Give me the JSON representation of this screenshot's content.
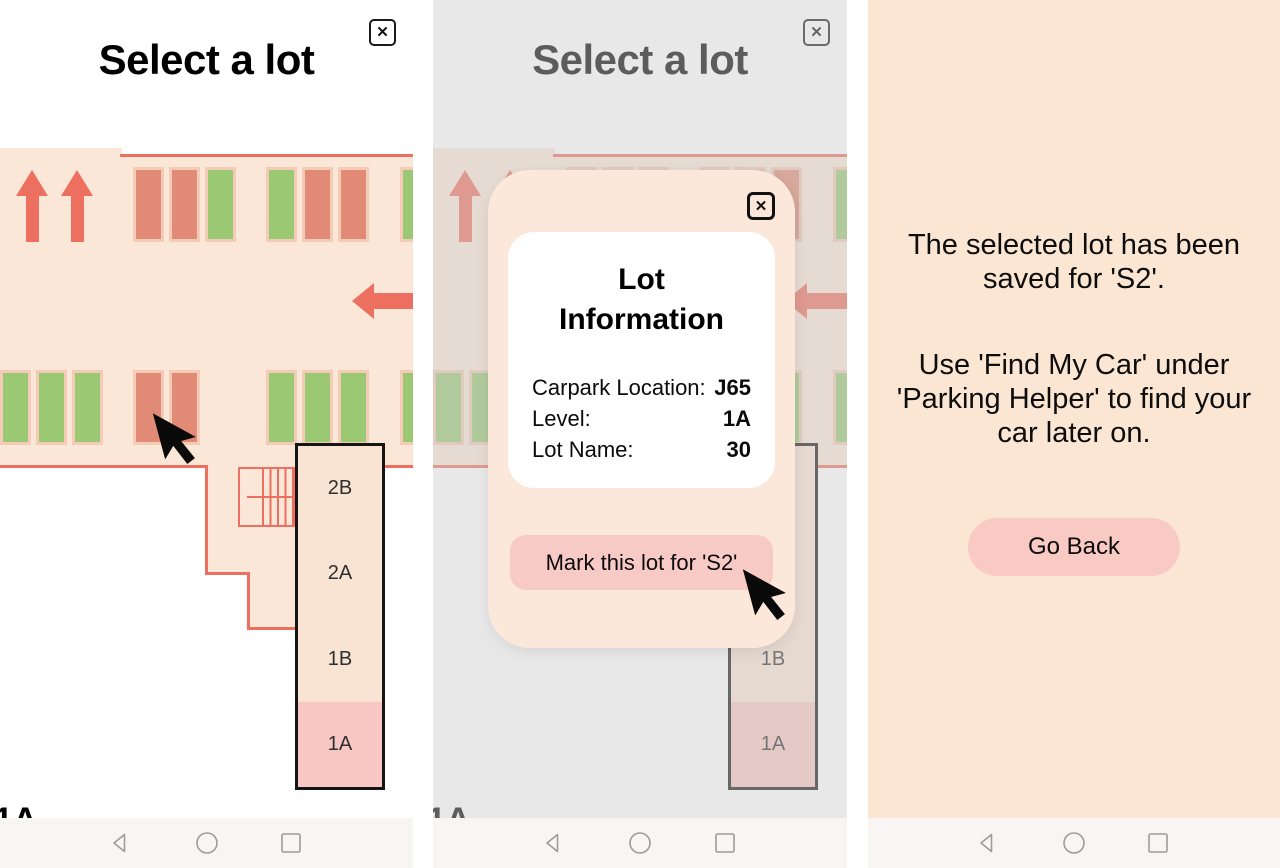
{
  "select_screen": {
    "title": "Select a lot",
    "close_glyph": "✕",
    "levels": [
      "2B",
      "2A",
      "1B",
      "1A"
    ],
    "selected_level": "1A",
    "partial_bottom_label": "1A",
    "map": {
      "row1_groups": [
        [
          "occupied",
          "occupied",
          "free"
        ],
        [
          "free",
          "occupied",
          "occupied"
        ],
        [
          "free"
        ]
      ],
      "row2_groups": [
        [
          "free",
          "free",
          "free"
        ],
        [
          "occupied",
          "occupied"
        ],
        [
          "free",
          "free",
          "free"
        ],
        [
          "free"
        ]
      ]
    }
  },
  "lot_info_modal": {
    "close_glyph": "✕",
    "title": "Lot Information",
    "rows": [
      {
        "label": "Carpark Location:",
        "value": "J65"
      },
      {
        "label": "Level:",
        "value": "1A"
      },
      {
        "label": "Lot Name:",
        "value": "30"
      }
    ],
    "mark_button_label": "Mark this lot for 'S2'"
  },
  "confirmation_screen": {
    "message_saved": "The selected lot has been saved for 'S2'.",
    "message_hint": "Use 'Find My Car' under 'Parking Helper' to find your car later on.",
    "go_back_label": "Go Back"
  },
  "colors": {
    "map_background": "#fbe7d7",
    "accent_red": "#ed6f5f",
    "spot_occupied": "#e18a76",
    "spot_free": "#9ac873",
    "selected_pink": "#f8c7c3",
    "button_pink": "#f8cac5",
    "confirm_background": "#fbe6d3",
    "navbar_background": "#f7f6f4"
  },
  "navbar": {
    "icons": [
      "back",
      "home",
      "recents"
    ]
  }
}
